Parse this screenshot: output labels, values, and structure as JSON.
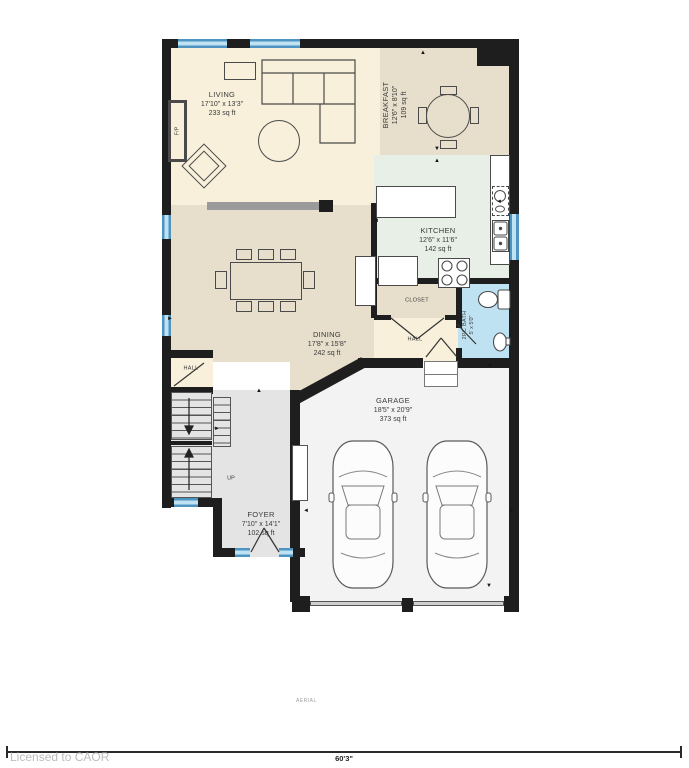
{
  "footer": {
    "license": "Licensed to CAOR",
    "scale": "60'3\"",
    "watermark": "AERIAL"
  },
  "rooms": {
    "living": {
      "name": "LIVING",
      "dims": "17'10\" x 13'3\"",
      "area": "233 sq ft"
    },
    "breakfast": {
      "name": "BREAKFAST",
      "dims": "12'6\" x 8'10\"",
      "area": "109 sq ft"
    },
    "kitchen": {
      "name": "KITCHEN",
      "dims": "12'6\" x 11'6\"",
      "area": "142 sq ft"
    },
    "dining": {
      "name": "DINING",
      "dims": "17'8\" x 15'8\"",
      "area": "242 sq ft"
    },
    "closet": {
      "name": "CLOSET"
    },
    "hall_upper": {
      "name": "HALL"
    },
    "bath": {
      "name": "2PC BATH",
      "dims": "5' x 5'0\""
    },
    "garage": {
      "name": "GARAGE",
      "dims": "18'5\" x 20'9\"",
      "area": "373 sq ft"
    },
    "foyer": {
      "name": "FOYER",
      "dims": "7'10\" x 14'1\"",
      "area": "102 sq ft"
    },
    "hall_lower": {
      "name": "HALL"
    },
    "stairs": {
      "direction": "UP"
    },
    "fireplace": {
      "label": "F/P"
    }
  },
  "colors": {
    "wall": "#1e1e1e",
    "window": "#5aa7d2",
    "cream": "#f8f0da",
    "tan": "#e7decb",
    "kitchen_mint": "#e7efe7",
    "bath_blue": "#bfe2f2",
    "garage_gray": "#f3f3f4",
    "foyer_gray": "#e4e4e4",
    "beam_gray": "#9a9a9a"
  },
  "icons": {
    "arrow_up": "▲",
    "arrow_down": "▼",
    "arrow_left": "◄",
    "arrow_right": "►"
  }
}
